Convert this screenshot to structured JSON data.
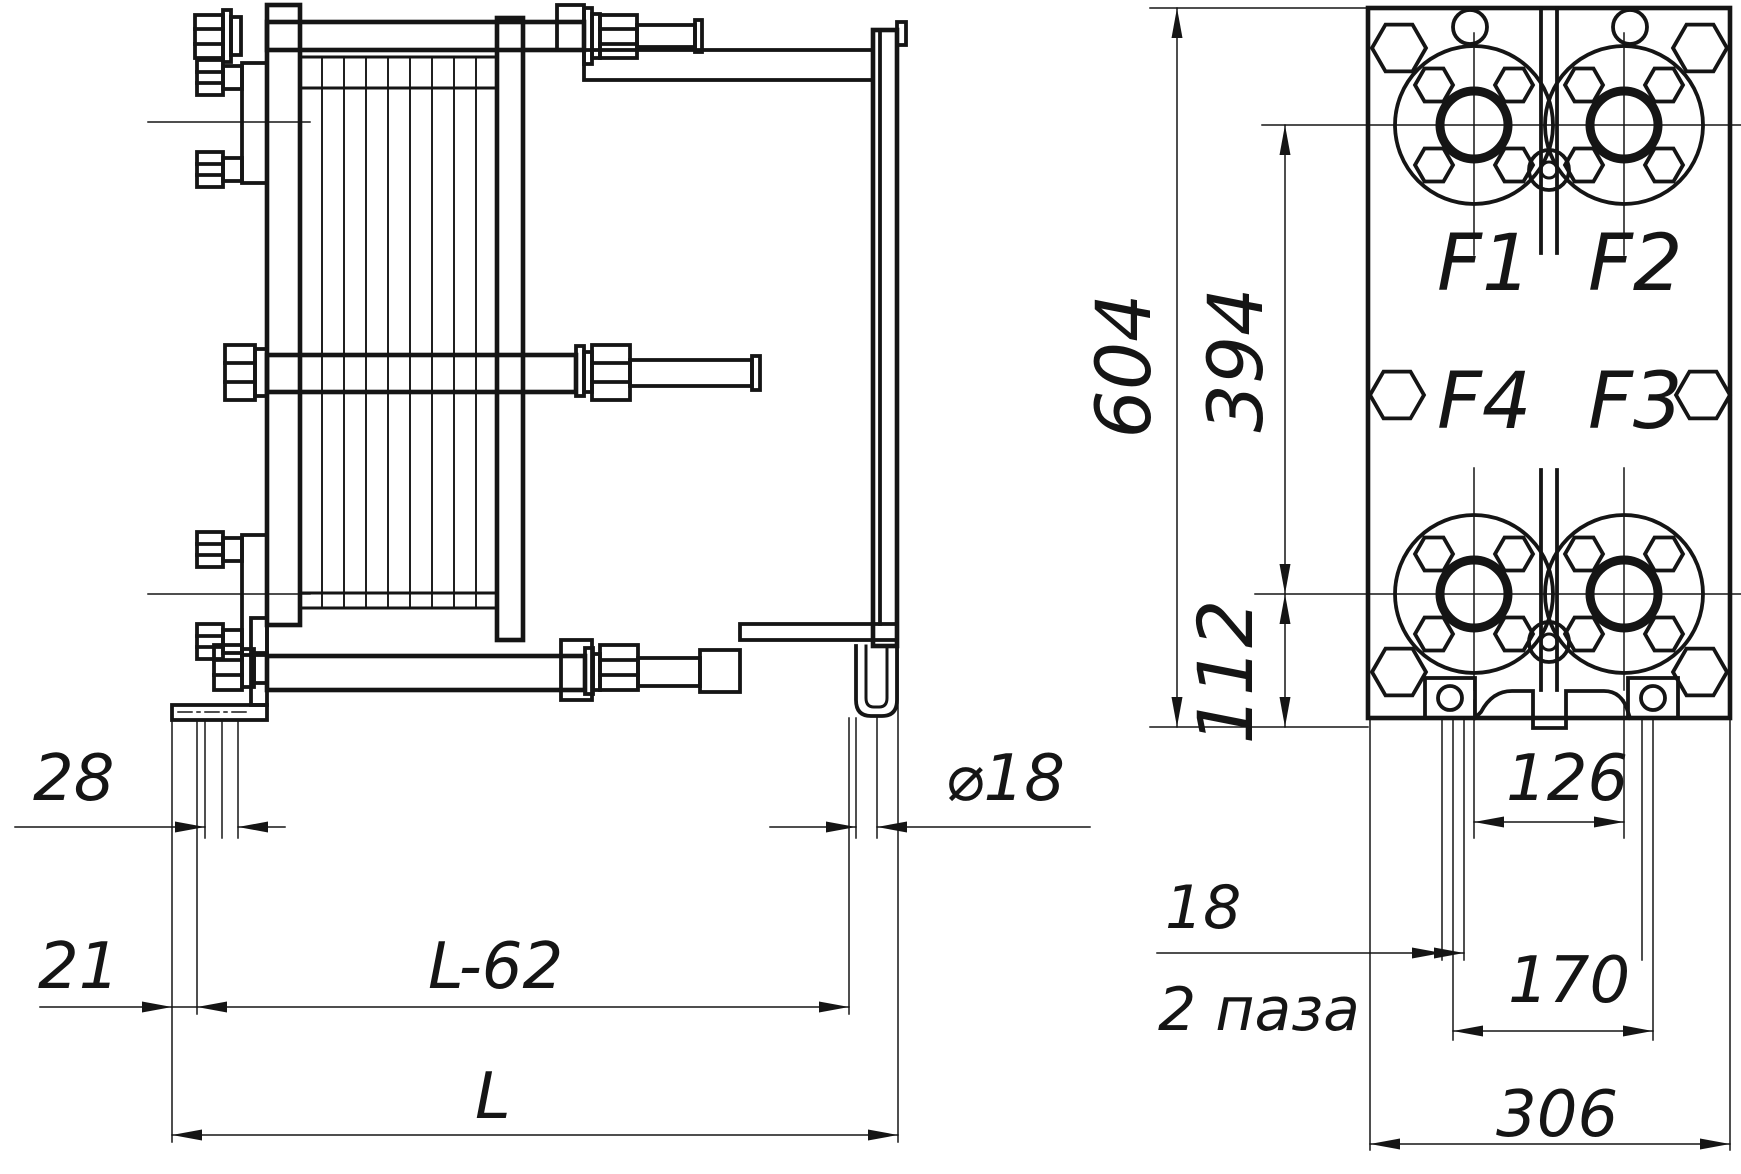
{
  "side_view": {
    "dim_28": "28",
    "dim_21": "21",
    "dim_L62": "L-62",
    "dim_L": "L",
    "dim_dia18": "⌀18"
  },
  "front_view": {
    "port_f1": "F1",
    "port_f2": "F2",
    "port_f3": "F3",
    "port_f4": "F4",
    "dim_604": "604",
    "dim_394": "394",
    "dim_112": "112",
    "dim_126": "126",
    "slot_width": "18",
    "slot_note": "2 паза",
    "dim_170": "170",
    "dim_306": "306"
  }
}
